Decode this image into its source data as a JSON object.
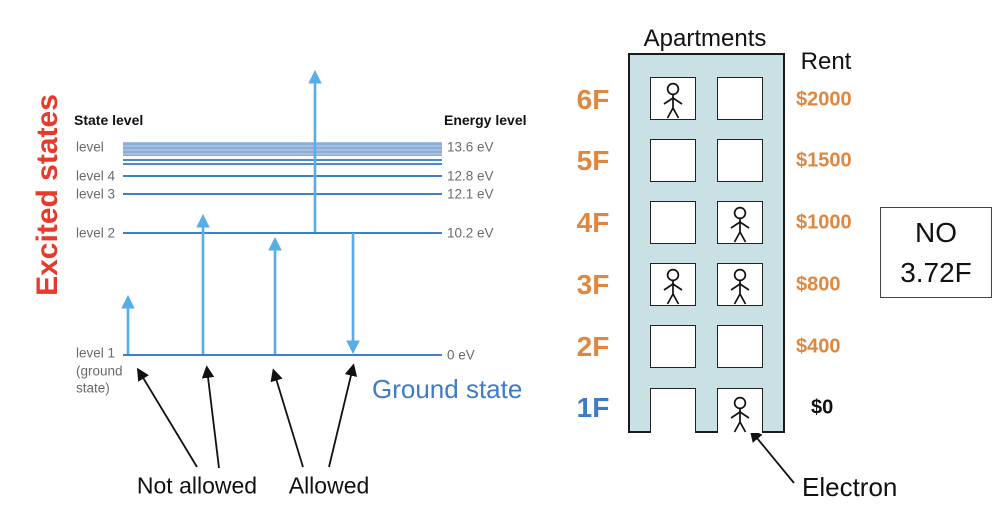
{
  "colors": {
    "excited_red": "#e8392b",
    "ground_blue": "#3d7cc9",
    "transition_arrow_blue": "#57ade6",
    "level_line_blue": "#3e82c4",
    "floor_orange": "#e0873f",
    "building_fill": "#c9e0e4"
  },
  "energy_diagram": {
    "rotated_title": "Excited states",
    "state_header": "State level",
    "energy_header": "Energy level",
    "levels": [
      {
        "label": "level",
        "energy": "13.6 eV"
      },
      {
        "label": "level 4",
        "energy": "12.8 eV"
      },
      {
        "label": "level 3",
        "energy": "12.1 eV"
      },
      {
        "label": "level 2",
        "energy": "10.2 eV"
      },
      {
        "label": "level 1",
        "sub_line1": "(ground",
        "sub_line2": "state)",
        "energy": "0 eV"
      }
    ],
    "ground_state_label": "Ground state",
    "not_allowed_label": "Not allowed",
    "allowed_label": "Allowed"
  },
  "apartments": {
    "title": "Apartments",
    "rent_header": "Rent",
    "floors": [
      {
        "label": "6F",
        "rent": "$2000",
        "occupied_left": true,
        "occupied_right": false,
        "highlight": false
      },
      {
        "label": "5F",
        "rent": "$1500",
        "occupied_left": false,
        "occupied_right": false,
        "highlight": false
      },
      {
        "label": "4F",
        "rent": "$1000",
        "occupied_left": false,
        "occupied_right": true,
        "highlight": false
      },
      {
        "label": "3F",
        "rent": "$800",
        "occupied_left": true,
        "occupied_right": true,
        "highlight": false
      },
      {
        "label": "2F",
        "rent": "$400",
        "occupied_left": false,
        "occupied_right": false,
        "highlight": false
      },
      {
        "label": "1F",
        "rent": "$0",
        "occupied_left": false,
        "occupied_right": true,
        "highlight": true
      }
    ],
    "electron_label": "Electron"
  },
  "note_box": {
    "line1": "NO",
    "line2": "3.72F"
  }
}
